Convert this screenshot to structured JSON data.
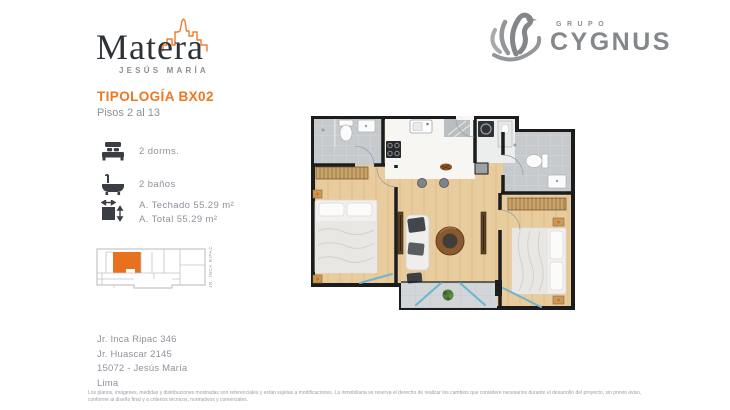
{
  "colors": {
    "accent_orange": "#F0761F",
    "keyplan_unit_orange": "#E8711F",
    "text_muted_gray": "#8D939B",
    "logo_gray": "#85888B",
    "ink": "#2E3237",
    "plan_wall_black": "#1C1C1C",
    "plan_wood_floor": "#E8CC9D",
    "plan_tile_gray": "#C6CACD",
    "plan_window_blue": "#6FB3D2"
  },
  "header": {
    "brand": {
      "name": "Matera",
      "district": "JESÚS MARÍA"
    },
    "developer": {
      "group": "GRUPO",
      "name": "CYGNUS"
    }
  },
  "typology": {
    "title": "TIPOLOGÍA BX02",
    "floors_label": "Pisos 2 al 13"
  },
  "features": [
    {
      "icon": "bed-icon",
      "label": "2 dorms."
    },
    {
      "icon": "bathtub-icon",
      "label": "2 baños"
    },
    {
      "icon": "area-icon",
      "label": "A. Techado 55.29 m²",
      "label2": "A. Total 55.29 m²"
    }
  ],
  "keyplan": {
    "street_label": "JR. INCA RIPAC"
  },
  "address": {
    "lines": [
      "Jr. Inca Ripac 346",
      "Jr. Huascar 2145",
      "15072 - Jesús María",
      "Lima"
    ]
  },
  "footer": {
    "disclaimer": "Los planos, imágenes, medidas y distribuciones mostradas son referenciales y están sujetas a modificaciones. La inmobiliaria se reserva el derecho de realizar los cambios que considere necesarios durante el desarrollo del proyecto, sin previo aviso, conforme al diseño final y a criterios técnicos, normativos y comerciales."
  }
}
